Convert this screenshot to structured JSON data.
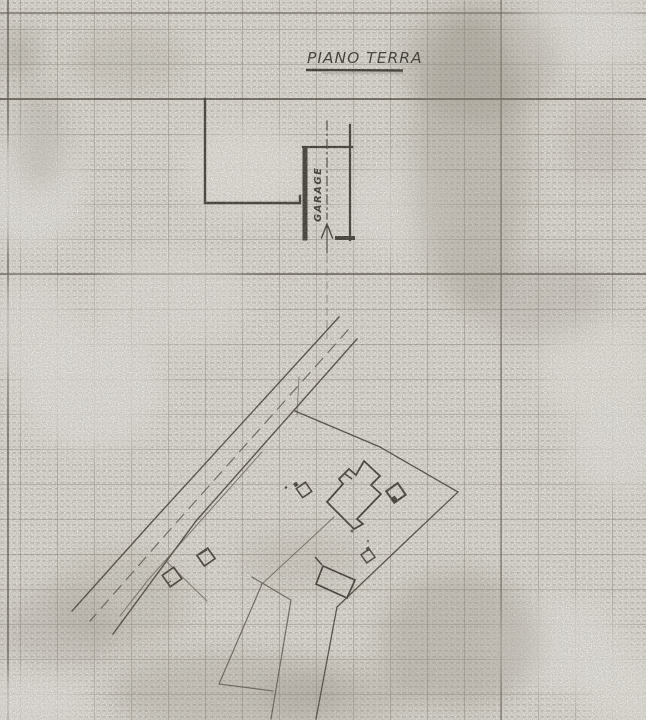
{
  "drawing": {
    "title": "PIANO TERRA",
    "garage_label": "GARAGE"
  },
  "colors": {
    "paper": "#f6f4ef",
    "ink": "#221f1a",
    "grid_medium": "#837b70",
    "grid_heavy": "#4d473f",
    "faint_line": "#45403a"
  }
}
